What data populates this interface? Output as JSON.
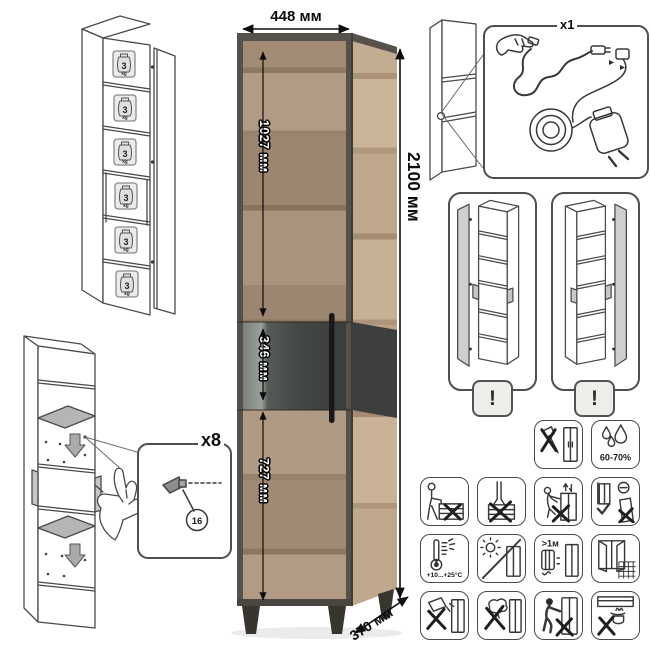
{
  "dimensions": {
    "width": "448 мм",
    "height": "2100 мм",
    "depth": "370 мм",
    "upper_door": "1027 мм",
    "middle_section": "346 мм",
    "lower_door": "727 мм"
  },
  "shelf_load": {
    "value": "3",
    "unit": "kg",
    "shelf_count": 6
  },
  "lighting_kit": {
    "quantity": "x1"
  },
  "door_reversal": {
    "warning": "!"
  },
  "shelf_supports": {
    "quantity": "x8",
    "part_number": "16"
  },
  "care_icons": [
    {
      "name": "no-sharp-impact-icon",
      "text": ""
    },
    {
      "name": "humidity-range-icon",
      "text": "60-70%"
    },
    {
      "name": "no-sitting-icon",
      "text": ""
    },
    {
      "name": "no-standing-icon",
      "text": ""
    },
    {
      "name": "no-climbing-icon",
      "text": ""
    },
    {
      "name": "anchor-to-wall-icon",
      "text": ""
    },
    {
      "name": "temperature-range-icon",
      "text": "+10...+25°C"
    },
    {
      "name": "no-direct-sunlight-icon",
      "text": ""
    },
    {
      "name": "heat-distance-icon",
      "text": ">1м"
    },
    {
      "name": "ventilation-icon",
      "text": ""
    },
    {
      "name": "no-liquids-icon",
      "text": ""
    },
    {
      "name": "no-wet-cleaning-icon",
      "text": ""
    },
    {
      "name": "no-dragging-icon",
      "text": ""
    },
    {
      "name": "no-heat-below-icon",
      "text": ""
    }
  ],
  "colors": {
    "line_art": "#4a4a4a",
    "wood_light": "#b19b85",
    "wood_dark": "#8a755f",
    "frame": "#56524b",
    "glass": "#444744",
    "handle": "#191919"
  }
}
